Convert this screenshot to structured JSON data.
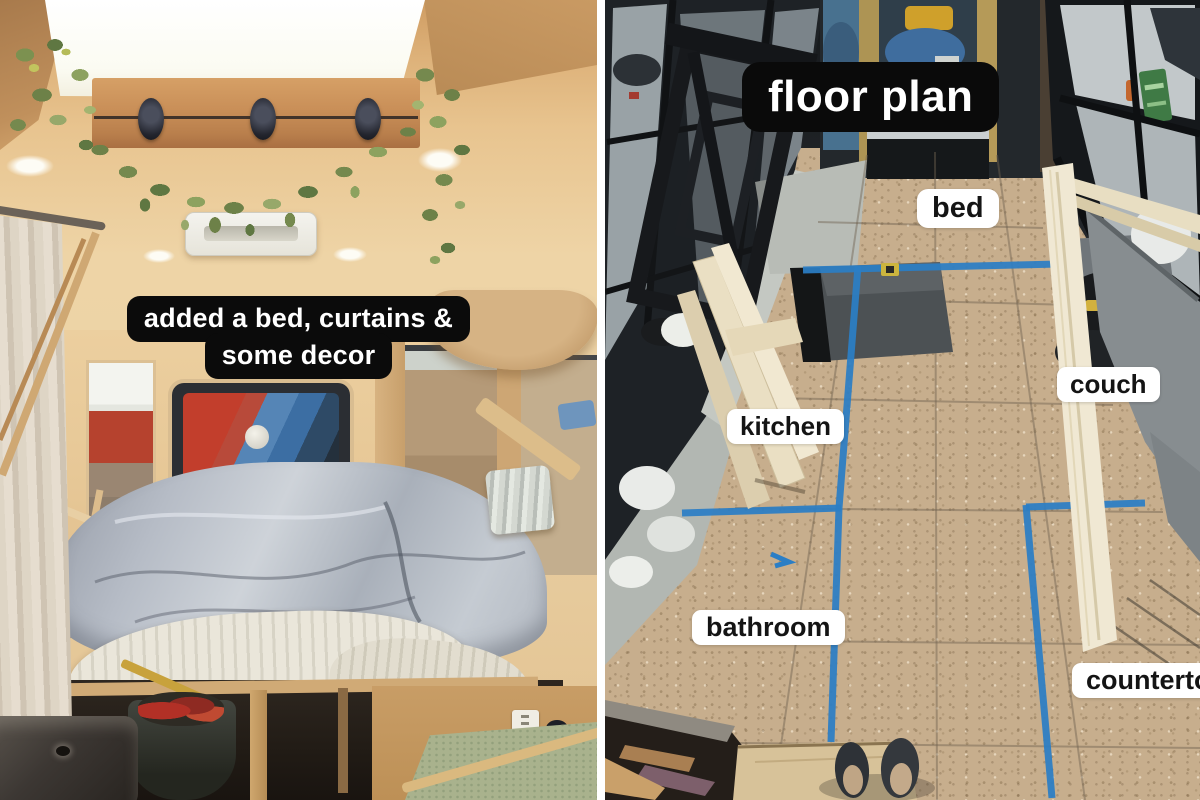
{
  "left_photo": {
    "caption_line1": "added a bed, curtains &",
    "caption_line2": "some decor"
  },
  "right_photo": {
    "title": "floor plan",
    "labels": [
      {
        "text": "bed"
      },
      {
        "text": "couch"
      },
      {
        "text": "kitchen"
      },
      {
        "text": "bathroom"
      },
      {
        "text": "countertop"
      }
    ]
  },
  "colors": {
    "tape_blue": "#2b7ec5",
    "dark_label_bg": "#0a0a0a",
    "light_label_bg": "#ffffff",
    "osb_floor": "#c7ae8d"
  }
}
